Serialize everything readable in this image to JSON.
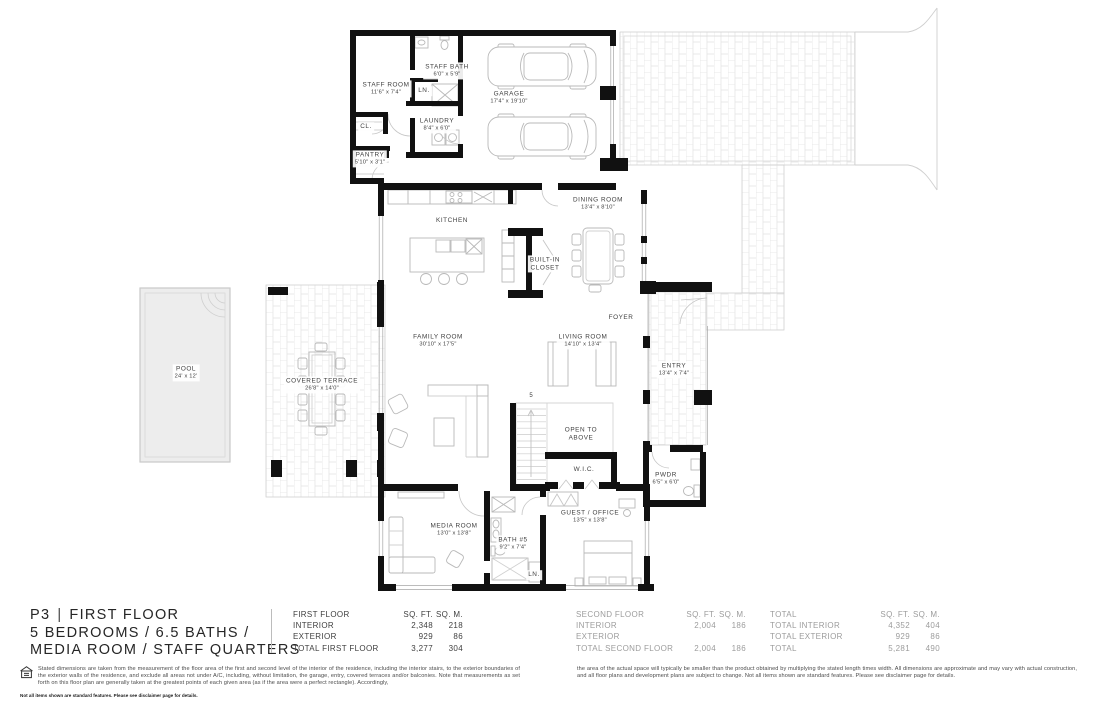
{
  "colors": {
    "wall": "#111111",
    "label_text": "#3f3f3f",
    "table_dark": "#3f3f3f",
    "table_muted": "#9c9c9c",
    "paving_line": "#e0e0e0",
    "pool_fill": "#ededed",
    "furniture_line": "#b9b9b9"
  },
  "plan": {
    "rooms": {
      "staff_room": {
        "name": "STAFF ROOM",
        "dims": "11'6\" x 7'4\""
      },
      "staff_bath": {
        "name": "STAFF BATH",
        "dims": "6'0\" x 5'9\""
      },
      "laundry": {
        "name": "LAUNDRY",
        "dims": "8'4\" x 6'0\""
      },
      "pantry": {
        "name": "PANTRY",
        "dims": "5'10\" x 3'1\""
      },
      "garage": {
        "name": "GARAGE",
        "dims": "17'4\" x 19'10\""
      },
      "kitchen": {
        "name": "KITCHEN"
      },
      "dining_room": {
        "name": "DINING ROOM",
        "dims": "13'4\" x 8'10\""
      },
      "built_in_closet": {
        "line1": "BUILT-IN",
        "line2": "CLOSET"
      },
      "foyer": {
        "name": "FOYER"
      },
      "family_room": {
        "name": "FAMILY ROOM",
        "dims": "30'10\" x 17'5\""
      },
      "living_room": {
        "name": "LIVING ROOM",
        "dims": "14'10\" x 13'4\""
      },
      "entry": {
        "name": "ENTRY",
        "dims": "13'4\" x 7'4\""
      },
      "covered_terrace": {
        "name": "COVERED TERRACE",
        "dims": "26'8\" x 14'0\""
      },
      "pool": {
        "name": "POOL",
        "dims": "24' x 12'"
      },
      "open_to_above": {
        "line1": "OPEN TO",
        "line2": "ABOVE"
      },
      "wic": {
        "name": "W.I.C."
      },
      "pwdr": {
        "name": "PWDR",
        "dims": "6'5\" x 6'0\""
      },
      "media_room": {
        "name": "MEDIA ROOM",
        "dims": "13'0\" x 13'8\""
      },
      "bath_5": {
        "name": "BATH #5",
        "dims": "9'2\" x 7'4\""
      },
      "guest_office": {
        "name": "GUEST / OFFICE",
        "dims": "13'5\" x 13'8\""
      },
      "cl": {
        "name": "CL."
      },
      "ln_upper": {
        "name": "LN."
      },
      "ln_lower": {
        "name": "LN."
      }
    },
    "markers": {
      "stair": "5"
    }
  },
  "title": {
    "page": "P3",
    "separator": "|",
    "name": "FIRST FLOOR",
    "bed_bath_line": "5 BEDROOMS  /  6.5 BATHS  /",
    "media_line": "MEDIA ROOM  /  STAFF QUARTERS"
  },
  "area_tables": {
    "first_floor": {
      "header": {
        "label": "FIRST FLOOR",
        "sqft": "SQ. FT.",
        "sqm": "SQ. M."
      },
      "rows": [
        {
          "label": "INTERIOR",
          "sqft": "2,348",
          "sqm": "218"
        },
        {
          "label": "EXTERIOR",
          "sqft": "929",
          "sqm": "86"
        },
        {
          "label": "TOTAL FIRST FLOOR",
          "sqft": "3,277",
          "sqm": "304"
        }
      ]
    },
    "second_floor": {
      "header": {
        "label": "SECOND FLOOR",
        "sqft": "SQ. FT.",
        "sqm": "SQ. M."
      },
      "rows": [
        {
          "label": "INTERIOR",
          "sqft": "2,004",
          "sqm": "186"
        },
        {
          "label": "EXTERIOR",
          "sqft": "",
          "sqm": ""
        },
        {
          "label": "TOTAL SECOND FLOOR",
          "sqft": "2,004",
          "sqm": "186"
        }
      ]
    },
    "total": {
      "header": {
        "label": "TOTAL",
        "sqft": "SQ. FT.",
        "sqm": "SQ. M."
      },
      "rows": [
        {
          "label": "TOTAL INTERIOR",
          "sqft": "4,352",
          "sqm": "404"
        },
        {
          "label": "TOTAL EXTERIOR",
          "sqft": "929",
          "sqm": "86"
        },
        {
          "label": "TOTAL",
          "sqft": "5,281",
          "sqm": "490"
        }
      ]
    }
  },
  "disclaimers": {
    "left": "Stated dimensions are taken from the measurement of the floor area of the first and second level of the interior of the residence, including the interior stairs, to the exterior boundaries of the exterior walls of the residence, and exclude all areas not under A/C, including, without limitation, the garage, entry, covered terraces and/or balconies. Note that measurements as set forth on this floor plan are generally taken at the greatest points of each given area (as if the area were a perfect rectangle). Accordingly,",
    "right": "the area of the actual space will typically be smaller than the product obtained by multiplying the stated length times width. All dimensions are approximate and may vary with actual construction, and all floor plans and development plans are subject to change. Not all items shown are standard features. Please see disclaimer page for details.",
    "footnote": "Not all items shown are standard features. Please see disclaimer page for details."
  }
}
